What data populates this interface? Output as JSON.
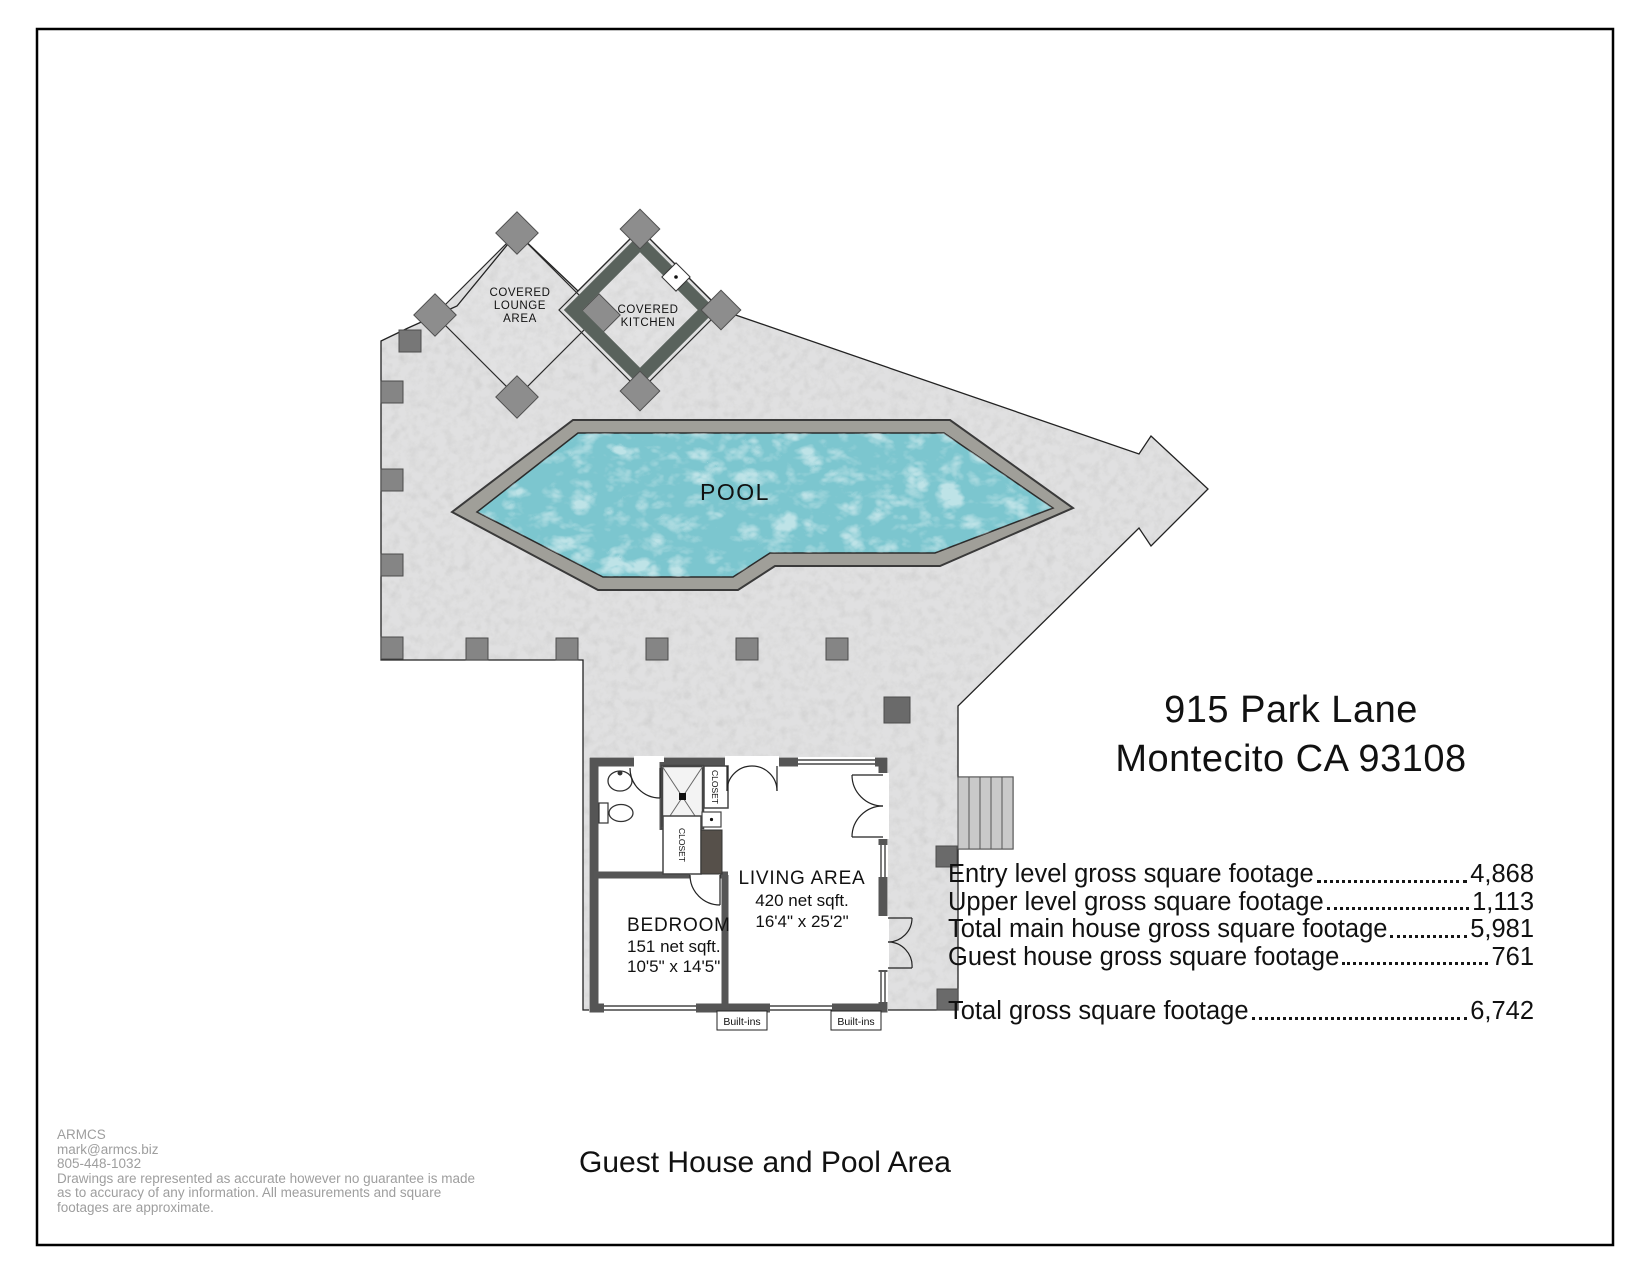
{
  "header": {
    "address_line1": "915 Park Lane",
    "address_line2": "Montecito CA 93108"
  },
  "plan": {
    "pool_label": "POOL",
    "covered_lounge": {
      "line1": "COVERED",
      "line2": "LOUNGE",
      "line3": "AREA"
    },
    "covered_kitchen": {
      "line1": "COVERED",
      "line2": "KITCHEN"
    },
    "living_area": {
      "name": "LIVING AREA",
      "area": "420 net sqft.",
      "dims": "16'4\" x 25'2\""
    },
    "bedroom": {
      "name": "BEDROOM",
      "area": "151 net sqft.",
      "dims": "10'5\" x 14'5\""
    },
    "closet_upper": "CLOSET",
    "closet_lower": "CLOSET",
    "built_ins_left": "Built-ins",
    "built_ins_right": "Built-ins"
  },
  "sqft_table": {
    "rows": [
      {
        "label": "Entry level gross square footage",
        "value": "4,868"
      },
      {
        "label": "Upper level gross square footage",
        "value": "1,113"
      },
      {
        "label": "Total main house gross square footage",
        "value": "5,981"
      },
      {
        "label": "Guest house gross square footage",
        "value": "761"
      }
    ],
    "total_label": "Total gross square footage",
    "total_value": "6,742"
  },
  "drawing_title": "Guest House and Pool Area",
  "footer": {
    "company": "ARMCS",
    "email": "mark@armcs.biz",
    "phone": "805-448-1032",
    "disclaimer_line1": "Drawings are represented as accurate however no guarantee is made",
    "disclaimer_line2": "as to accuracy of any information. All measurements and square",
    "disclaimer_line3": "footages are approximate."
  },
  "colors": {
    "deck": "#cfcfcf",
    "pool_water": "#7cc6cf",
    "pool_coping": "#a09f99",
    "wall": "#555555",
    "kitchen_counter": "#59625c",
    "footer_text": "#9e9e9e"
  }
}
